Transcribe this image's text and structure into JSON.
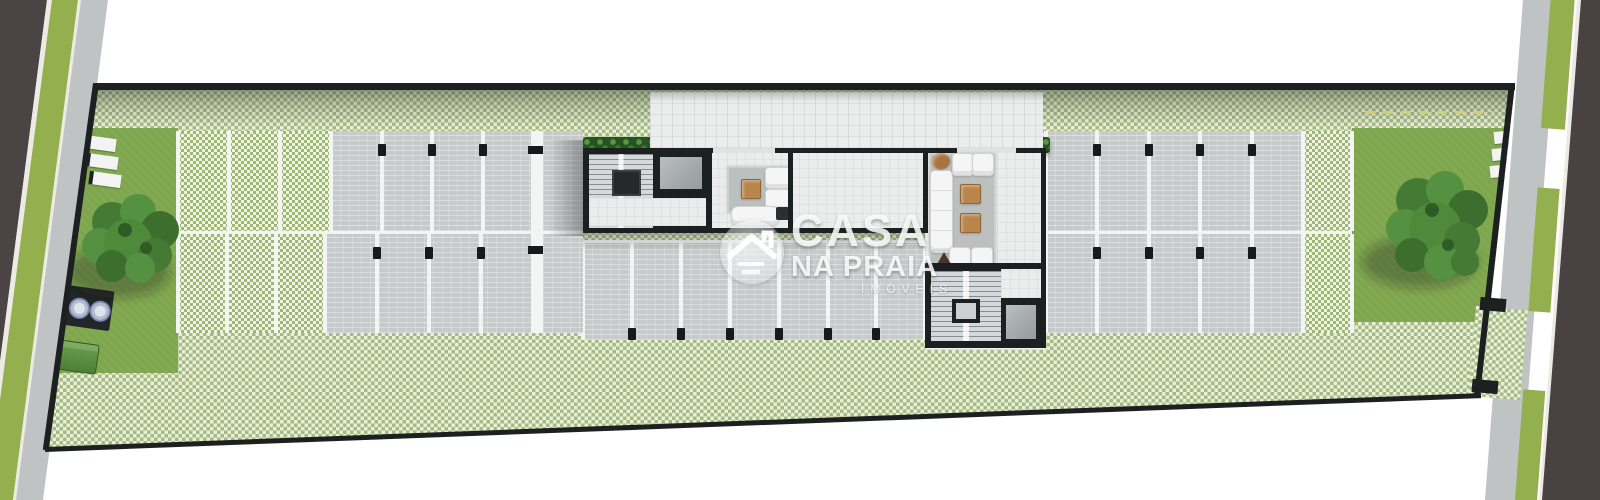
{
  "watermark": {
    "logo_icon": "house-roof-icon",
    "line1": "CASA",
    "line2": "NA PRAIA",
    "line3": "IMÓVEIS"
  },
  "colors": {
    "asphalt": "#4b4444",
    "asphalt_right": "#494243",
    "curb": "#eceae2",
    "verge": "#94af4d",
    "sidewalk": "#bfc3c4",
    "wall": "#1d2021",
    "lawn": "#7ea64d",
    "checker_green": "#a6bb80",
    "checker_light": "#e9eedd",
    "space_green": "#9db873",
    "space_light": "#f0f3e6",
    "paving": "#c6cacb",
    "line_white": "#f3f5f4",
    "floor": "#ebedec",
    "stair": "#d6d9dc",
    "rug": "#bcc0bf",
    "elevator": "#a2a8ab",
    "wood": "#b8854d",
    "hedge": "#2f6326",
    "tree": "#4f8f3a",
    "bin": "#5d9040",
    "column": "#17191a",
    "watermark": "#ffffff"
  },
  "parking": {
    "sections": [
      {
        "id": "north-left-permeable",
        "x": 178,
        "y": 131,
        "h": 100,
        "spaces": 3,
        "space_w": 51,
        "surface": "green",
        "columns": "none"
      },
      {
        "id": "north-left-paved",
        "x": 331,
        "y": 131,
        "h": 100,
        "spaces": 4,
        "space_w": 50.5,
        "surface": "gray",
        "columns": "top"
      },
      {
        "id": "north-right-paved",
        "x": 1046,
        "y": 131,
        "h": 100,
        "spaces": 5,
        "space_w": 51.4,
        "surface": "gray",
        "columns": "top"
      },
      {
        "id": "north-right-permeable",
        "x": 1303,
        "y": 131,
        "h": 100,
        "spaces": 1,
        "space_w": 49,
        "surface": "green",
        "columns": "none"
      },
      {
        "id": "south-left-permeable",
        "x": 178,
        "y": 234,
        "h": 99,
        "spaces": 3,
        "space_w": 49,
        "surface": "green",
        "columns": "none"
      },
      {
        "id": "south-left-paved",
        "x": 325,
        "y": 234,
        "h": 99,
        "spaces": 4,
        "space_w": 52,
        "surface": "gray",
        "columns": "top"
      },
      {
        "id": "center-paved",
        "x": 583,
        "y": 243,
        "h": 97,
        "spaces": 7,
        "space_w": 48.9,
        "surface": "gray",
        "columns": "bottom"
      },
      {
        "id": "south-right-paved",
        "x": 1046,
        "y": 234,
        "h": 99,
        "spaces": 5,
        "space_w": 51.4,
        "surface": "gray",
        "columns": "top"
      },
      {
        "id": "south-right-permeable",
        "x": 1303,
        "y": 234,
        "h": 99,
        "spaces": 1,
        "space_w": 49,
        "surface": "green",
        "columns": "none"
      }
    ]
  },
  "hedges": [
    {
      "x": 583,
      "w": 130
    },
    {
      "x": 775,
      "w": 133
    },
    {
      "x": 922,
      "w": 35
    },
    {
      "x": 1016,
      "w": 34
    }
  ]
}
